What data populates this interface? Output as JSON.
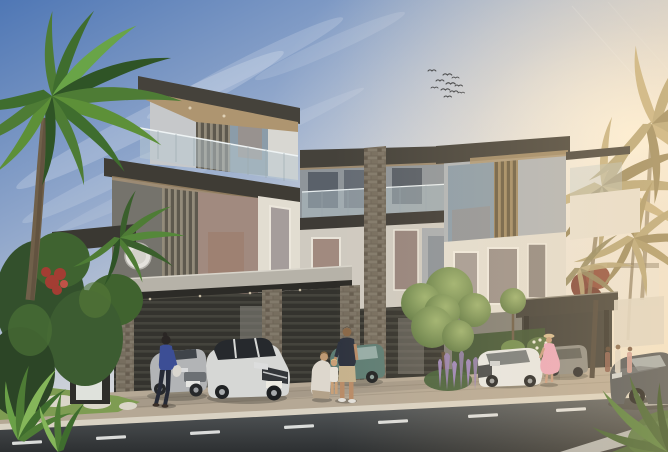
{
  "scene": {
    "type": "architectural-rendering",
    "description": "Modern flat-roof luxury townhouse villas at golden hour with tropical palms, landscaped garden, covered carports, parked cars and pedestrians along a street",
    "time_of_day": "late afternoon sunset glow from the right"
  },
  "palette": {
    "sky_top": "#4f77b5",
    "sky_upper": "#93a9cc",
    "sky_pale": "#d8d9dc",
    "sky_warm": "#f3e5cc",
    "sun_glow": "#fff6e2",
    "cloud": "#ffffff",
    "roof_fascia": "#45423b",
    "soffit_wood": "#ae9570",
    "facade_light": "#c6c8ca",
    "facade_white": "#d8d7d2",
    "stone_frame": "#e2ddd1",
    "glass_cool": "#8b9ca9",
    "glass_warm": "#a18a7f",
    "carport_dark": "#35342f",
    "palm_green": "#4e7c35",
    "palm_gold": "#b5a578",
    "topiary_light": "#9db26f",
    "topiary_dark": "#5a7440",
    "purple_flowers": "#9c85b8",
    "red_flowers": "#a33d33",
    "grass": "#7e9c52",
    "sidewalk": "#b5a895",
    "curb": "#d9d2c3",
    "road": "#5c6062",
    "road_dark": "#2d3032",
    "lane_marking": "#e9eae8",
    "bird": "#3c4046"
  },
  "sky": {
    "bird_count": 11,
    "has_contrails": true,
    "clouds": "wispy diagonal streaks upper-left"
  },
  "building": {
    "style": "contemporary villas, 3 storeys",
    "features": [
      "overhanging flat roof slabs",
      "glass balustrade balconies",
      "vertical timber louvers",
      "stacked stone piers",
      "floor-to-ceiling glazing",
      "covered carports",
      "round wall disc light"
    ]
  },
  "vehicles": [
    {
      "name": "silver-sedan",
      "type": "sedan parked in left carport",
      "color": "#b2b4b6"
    },
    {
      "name": "white-suv",
      "type": "compact SUV parked in left carport",
      "color": "#d6d7d5"
    },
    {
      "name": "teal-wagon",
      "type": "estate car in middle carport",
      "color": "#5e7d74"
    },
    {
      "name": "white-car",
      "type": "car on right driveway",
      "color": "#e6e7e5"
    },
    {
      "name": "grey-suv",
      "type": "SUV in right carport",
      "color": "#8b8a84"
    },
    {
      "name": "dark-sedan",
      "type": "dark sports sedan on street, lower right",
      "color": "#4c5258"
    }
  ],
  "people": [
    {
      "name": "woman-walking",
      "detail": "blue top, dark leggings, white bag",
      "outfit": "#3c4e95"
    },
    {
      "name": "man-standing",
      "detail": "navy t-shirt, khaki shorts",
      "outfit": "#2e333f"
    },
    {
      "name": "woman-crouching",
      "detail": "white top, kneeling with child",
      "outfit": "#ddd7cd"
    },
    {
      "name": "child",
      "detail": "small child in white",
      "outfit": "#e6e1d7"
    },
    {
      "name": "woman-pink-dress",
      "detail": "pink dress and sun hat",
      "outfit": "#eba6ba"
    },
    {
      "name": "distant-pedestrians",
      "detail": "three figures far right",
      "count": 3
    }
  ],
  "landscape": {
    "left": "green foreground palm and dense tropical shrubs with red blooms",
    "center": "cluster of clipped topiary balls with purple flower spikes",
    "right": "sun-backlit golden palms, dark red tree, white flower bush"
  },
  "road": {
    "lane_dash_count": 8,
    "surface": "asphalt",
    "verge": "grass with stepping stones, lower left"
  }
}
